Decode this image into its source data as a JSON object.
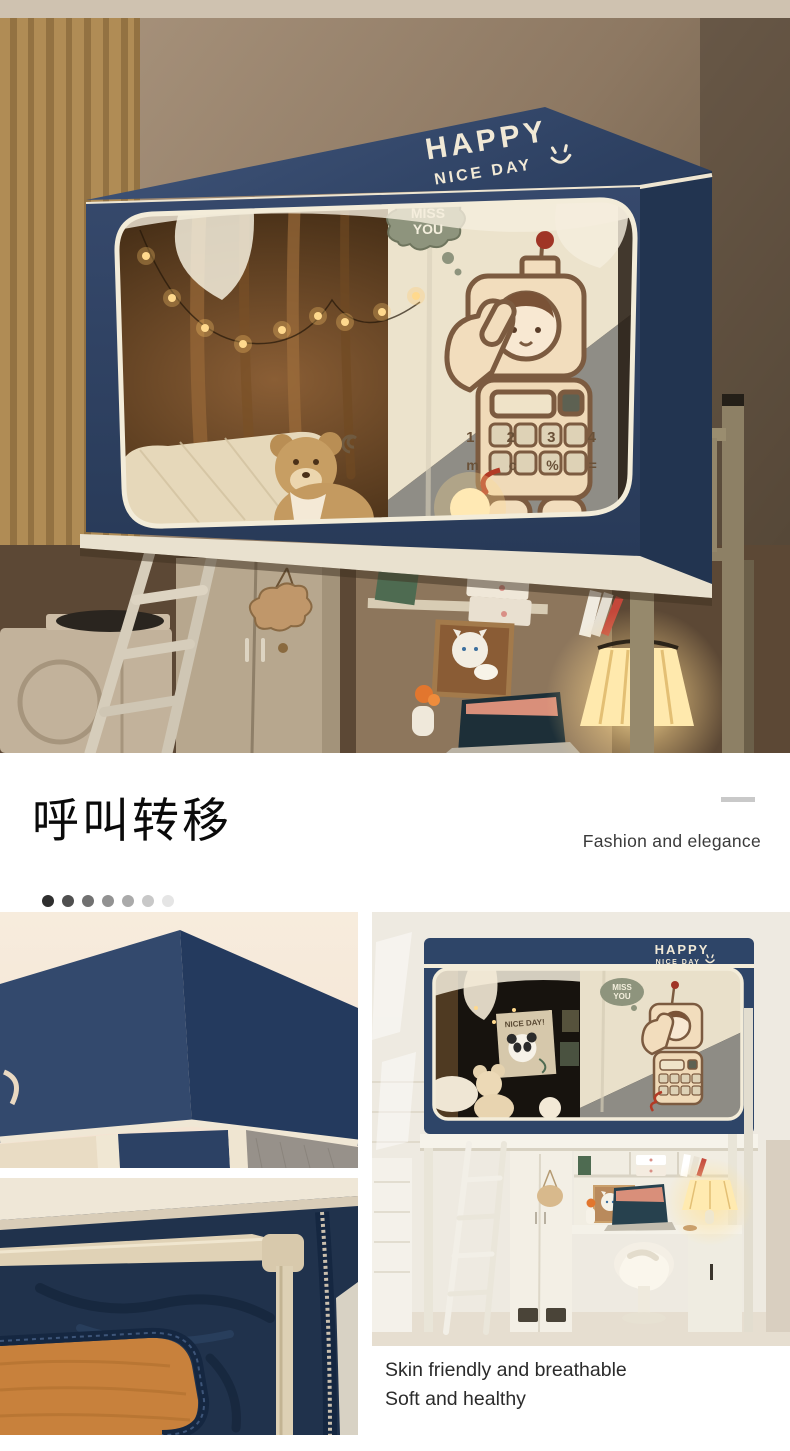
{
  "hero": {
    "brand_line1": "HAPPY",
    "brand_line2": "NICE DAY",
    "bubble_line1": "MISS",
    "bubble_line2": "YOU",
    "keypad_row1": "1 2 3 4",
    "keypad_row2": "m c % ="
  },
  "feature": {
    "title": "呼叫转移",
    "subtitle": "Fashion and elegance",
    "dots": [
      "#2e2e2e",
      "#4f4f4f",
      "#717171",
      "#929292",
      "#aaaaaa",
      "#c8c8c8",
      "#e5e5e5"
    ]
  },
  "gallery": {
    "banner_text": "NICE DAY!",
    "caption_line1": "Skin friendly and breathable",
    "caption_line2": "Soft and healthy"
  },
  "colors": {
    "navy": "#2f4568",
    "navy_dark": "#22344e",
    "piping": "#f2ead8",
    "wall_taupe": "#94816c",
    "curtain_gold": "#b08c55",
    "board_orange": "#c8813c",
    "lamp_glow": "#ffdf9e"
  }
}
